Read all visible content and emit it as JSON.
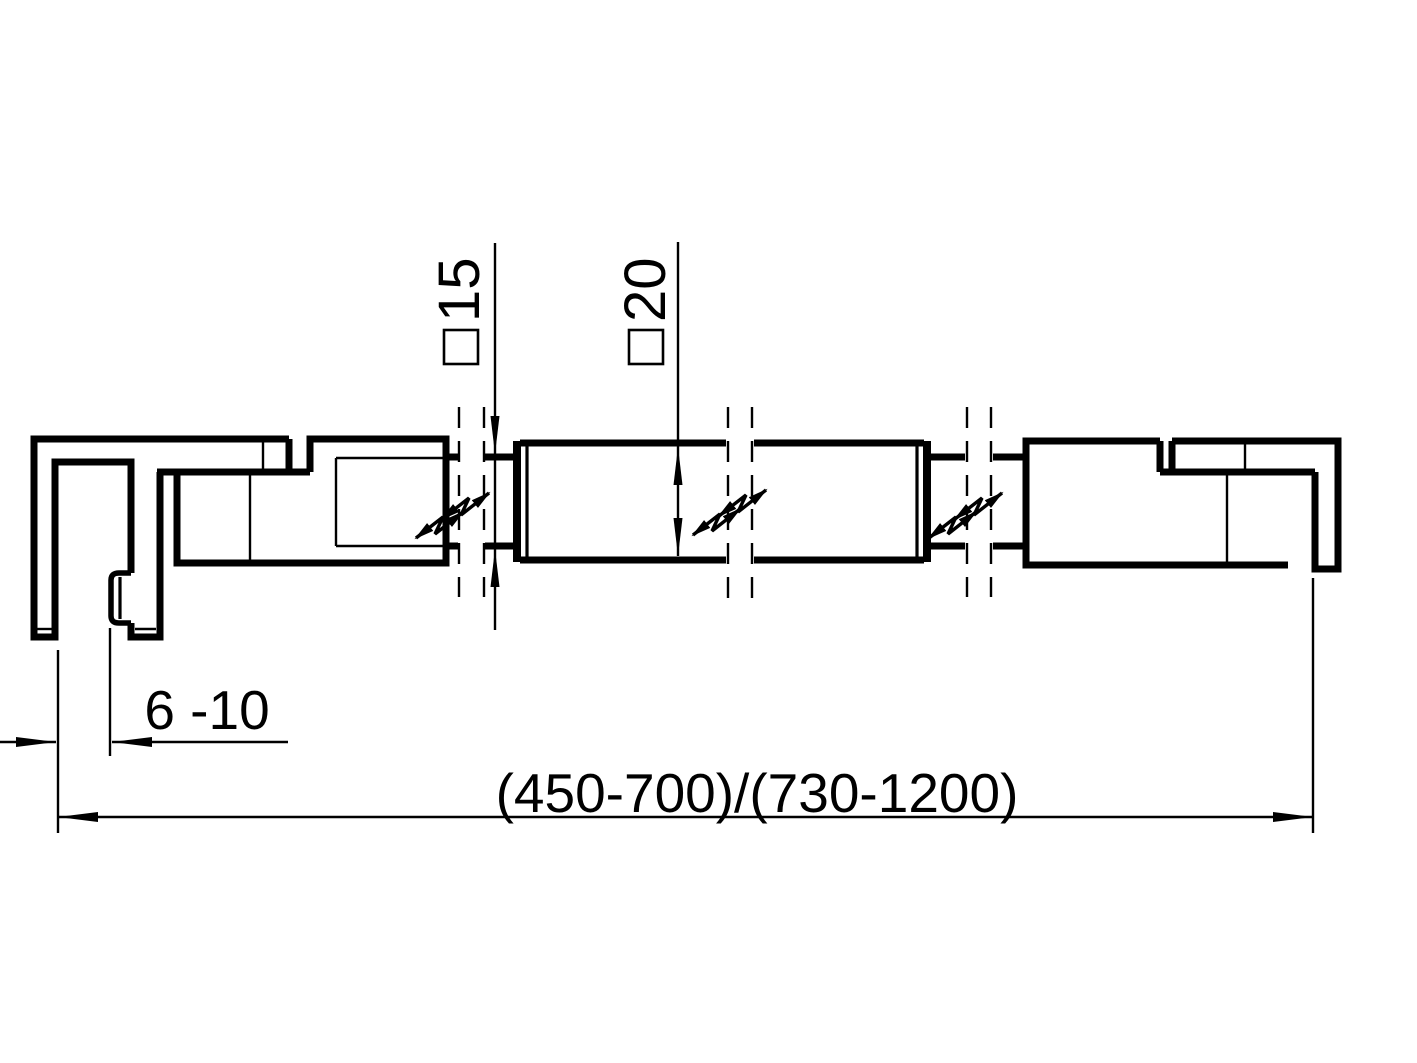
{
  "dimensions": {
    "small_bar": {
      "symbol": "□",
      "value": "15"
    },
    "large_bar": {
      "symbol": "□",
      "value": "20"
    },
    "glass_thickness": "6 -10",
    "overall_length": "(450-700)/(730-1200)"
  },
  "colors": {
    "line": "#000000",
    "background": "#ffffff"
  }
}
